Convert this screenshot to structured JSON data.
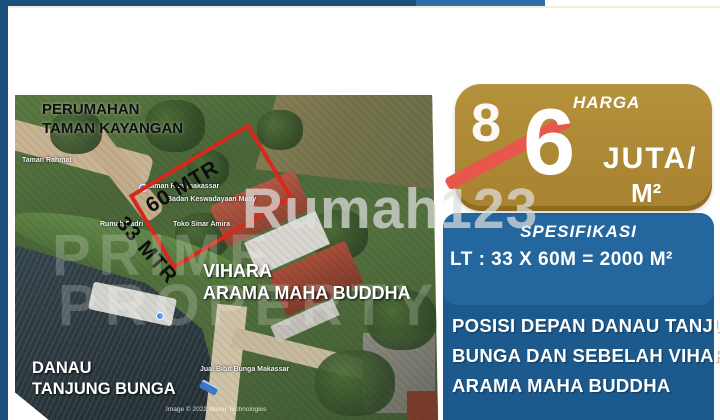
{
  "colors": {
    "accent_gold": "#ab8734",
    "panel_blue": "#1c5a8e",
    "spec_blue": "#24679f",
    "bar_navy": "#1c4e7e",
    "bar_blue": "#2e6da5",
    "plot_red": "#d6281c",
    "strike_red": "#e9564c"
  },
  "map": {
    "area_label": {
      "line1": "PERUMAHAN",
      "line2": "TAMAN KAYANGAN"
    },
    "plot": {
      "long_side": "60 MTR",
      "short_side": "33 MTR"
    },
    "vihara_label": {
      "line1": "VIHARA",
      "line2": "ARAMA MAHA BUDDHA"
    },
    "lake_label": {
      "line1": "DANAU",
      "line2": "TANJUNG BUNGA"
    },
    "poi_labels": {
      "l0": "Taman Rahmat",
      "l1": "taman Riza makassar",
      "l2": "Badan Keswadayaan Masy",
      "l3": "Rumah Padri",
      "l4": "Toko Sinar Amira",
      "l5": "Jual Bibit Bunga Makassar"
    },
    "attribution": "Image © 2022 Maxar Technologies"
  },
  "watermark": {
    "brand": "Rumah123",
    "agency_line1": "PRIME",
    "agency_line2": "PROPERTY"
  },
  "price_badge": {
    "title": "HARGA",
    "old_price": "8",
    "price": "6",
    "unit_line1": "JUTA/",
    "unit_line2": "M²"
  },
  "specification": {
    "title": "SPESIFIKASI",
    "land_size": "LT : 33 X 60M = 2000 M²"
  },
  "description": {
    "line1": "POSISI DEPAN DANAU TANJUNG",
    "line2": "BUNGA DAN SEBELAH VIHARA",
    "line3": "ARAMA MAHA BUDDHA"
  }
}
